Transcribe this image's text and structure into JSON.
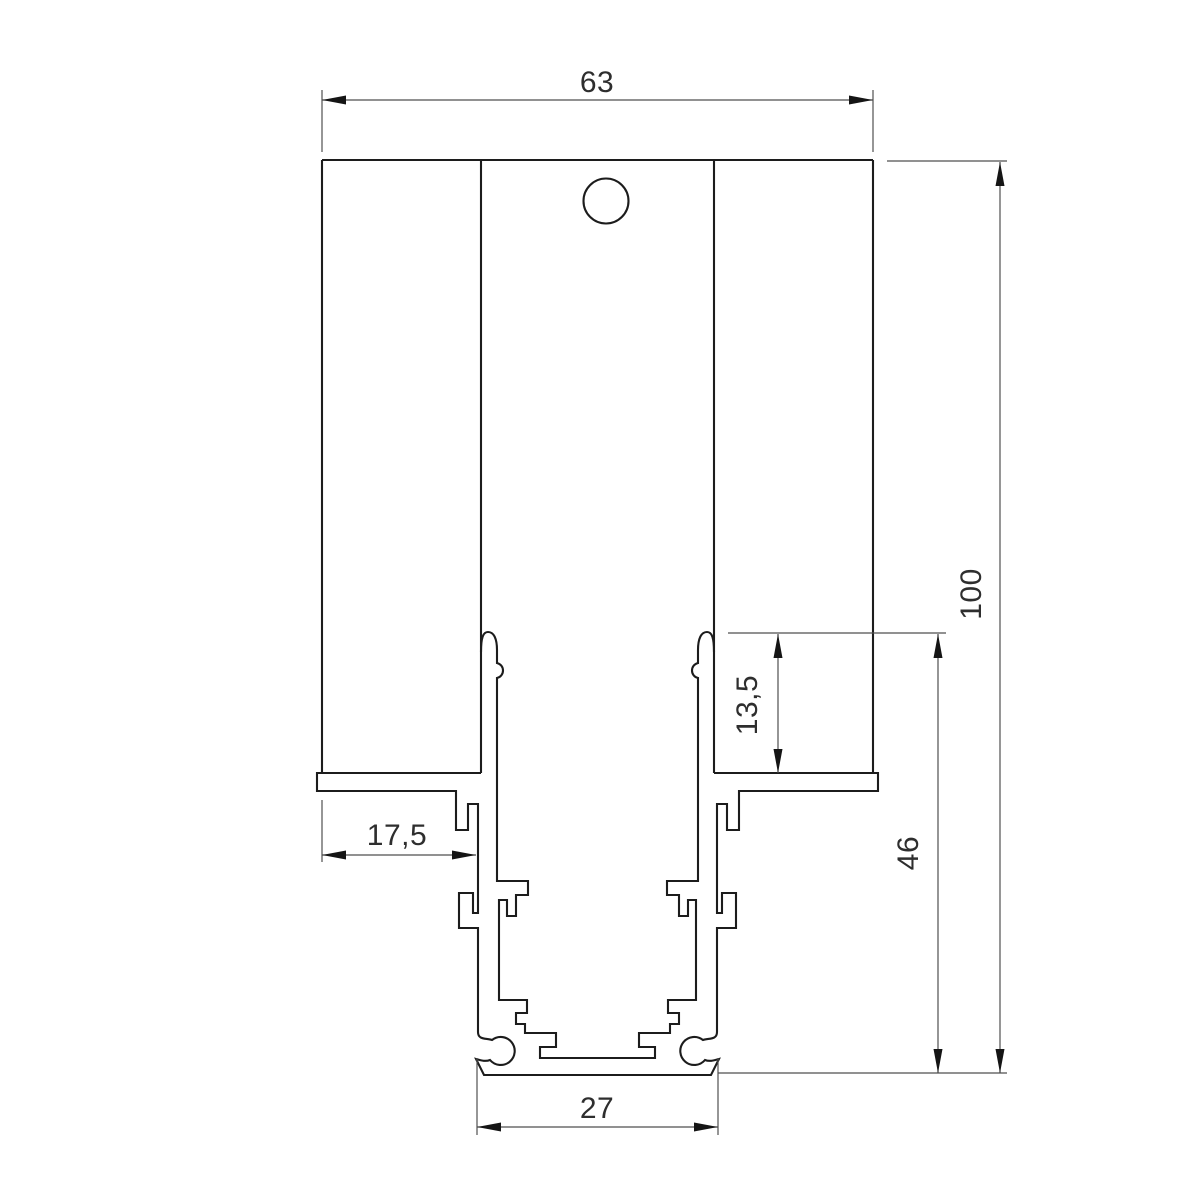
{
  "drawing": {
    "title": "aluminium profile cross-section drawing",
    "background": "#ffffff",
    "line_color": "#1c1c1c",
    "dim_color": "#4f4f4f",
    "text_color": "#2e2e2e",
    "dimensions": {
      "top_width": "63",
      "overall_height": "100",
      "inner_offset": "13,5",
      "lower_height": "46",
      "left_flange_width": "17,5",
      "bottom_width": "27"
    }
  }
}
